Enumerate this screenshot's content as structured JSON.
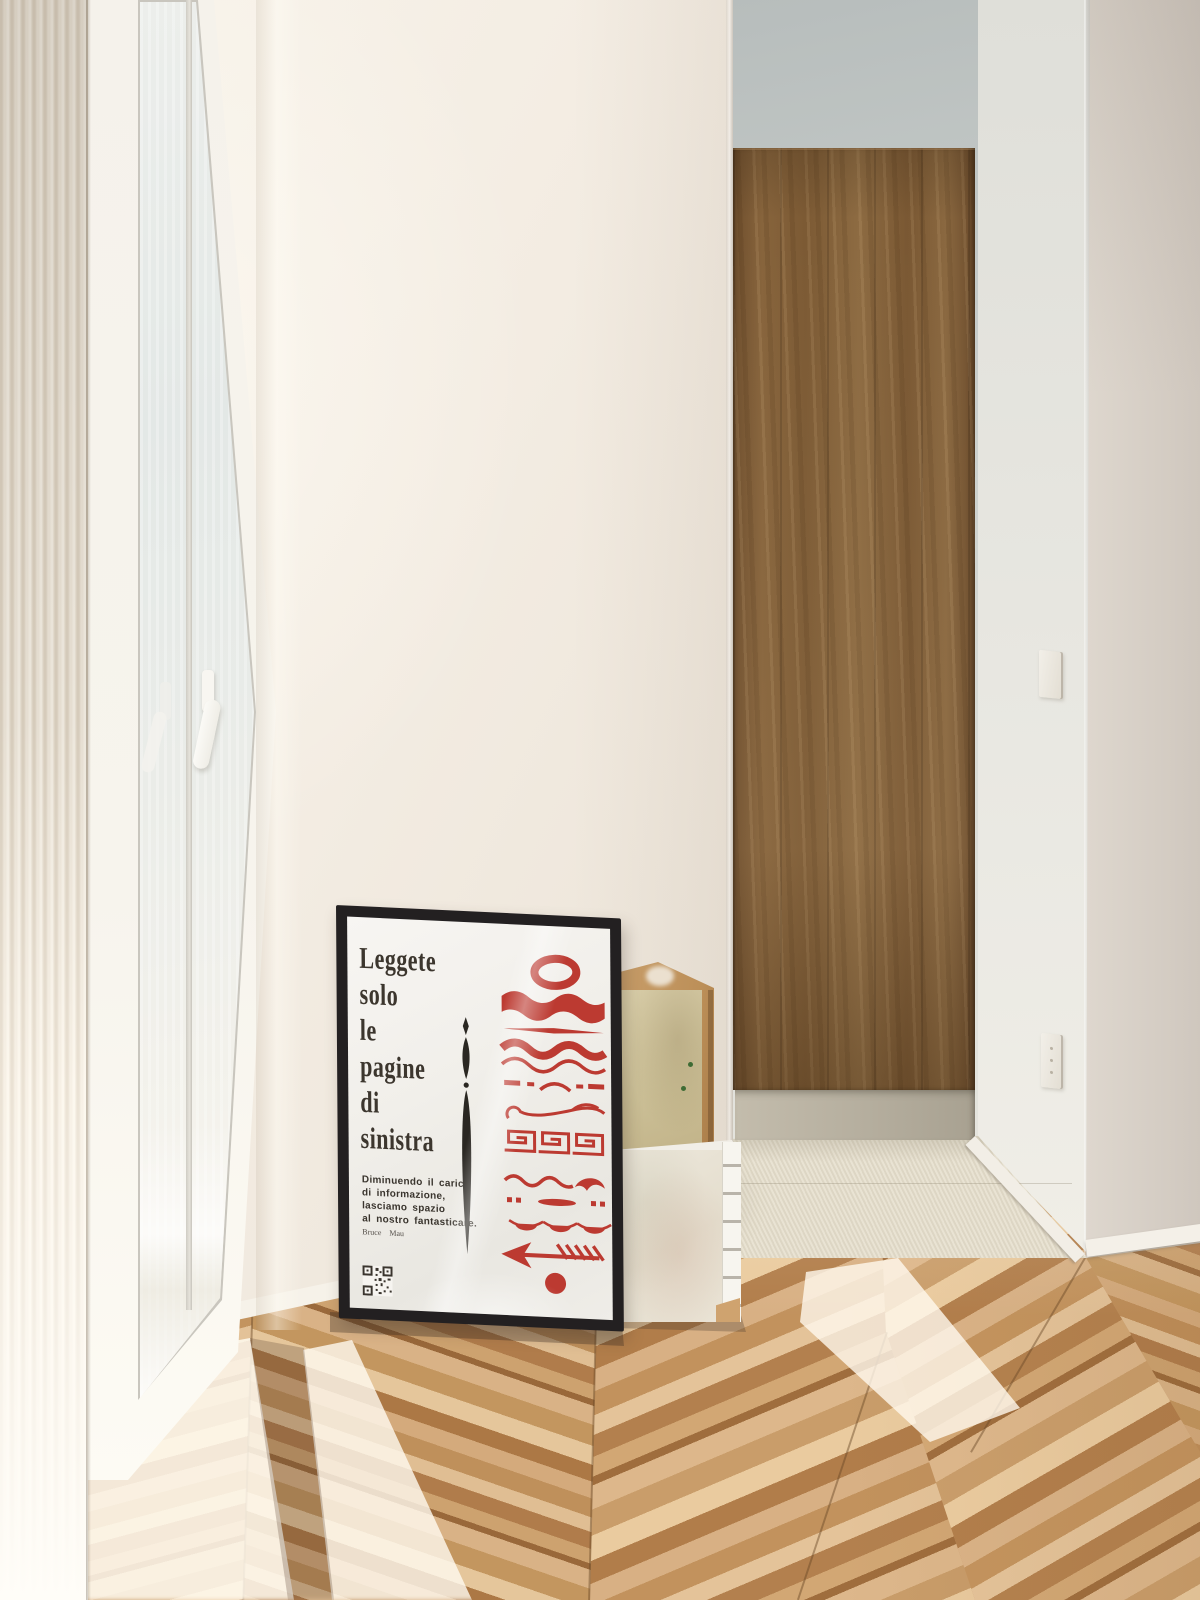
{
  "poster": {
    "title_lines": [
      "Leggete",
      "solo",
      "le",
      "pagine",
      "di",
      "sinistra"
    ],
    "body_lines": [
      "Diminuendo il carico",
      "di informazione,",
      "lasciamo spazio",
      "al nostro fantasticare."
    ],
    "attribution": "Bruce  Mau",
    "ornaments": [
      "ring",
      "wave-band",
      "tapered-rule",
      "double-wave",
      "dash-dot-row",
      "swirl-flourish",
      "greek-key-meander",
      "wave-crest",
      "dot-dash-row",
      "scallop-row",
      "feathered-arrow-left",
      "filled-dot",
      "vertical-spear"
    ],
    "colors": {
      "accent_red": "#BC3A31",
      "ink": "#3C362E",
      "paper": "#F3F1EC",
      "frame": "#232021"
    }
  },
  "palette": {
    "wall_cream": "#F2ECE2",
    "niche_gray": "#C9CEC9",
    "right_wall": "#D8D1C8",
    "wardrobe_wood": "#7E5C38",
    "floor_wood": "#C99D6F",
    "mat": "#E2DCCB",
    "sunlight": "#FFF9EE"
  }
}
